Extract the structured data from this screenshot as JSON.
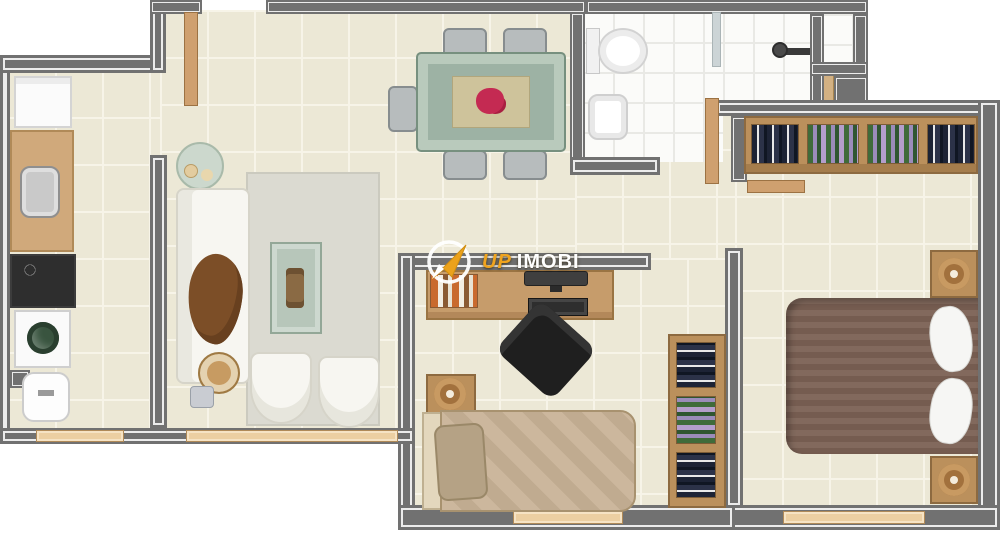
{
  "watermark": {
    "brand_part1": "UP",
    "brand_part2": "IMOBI",
    "icon": "paper-plane-arrow-icon",
    "accent_color": "#f0a41e",
    "text_color": "#ffffff"
  },
  "palette": {
    "wall_gray": "#717171",
    "wall_inner_stripe": "#ececec",
    "floor_tile_cream": "#ece8d6",
    "bathroom_tile_white": "#fbfbf9",
    "wood_furniture": "#bb905c",
    "door_wood": "#cfa06f",
    "window_sill": "#eccfa2",
    "master_bed_duvet": "#7b6154",
    "single_bed": "#c8b296",
    "sofa_white": "#f7f6f1",
    "throw_blanket_brown": "#7c4e27",
    "dining_table_green": "#9db2a4",
    "table_runner": "#cec39b",
    "flowers_red": "#c42a52",
    "washer_door_green": "#39543f",
    "office_chair_black": "#1f1f1f",
    "rug_gray": "#dbdad1"
  }
}
